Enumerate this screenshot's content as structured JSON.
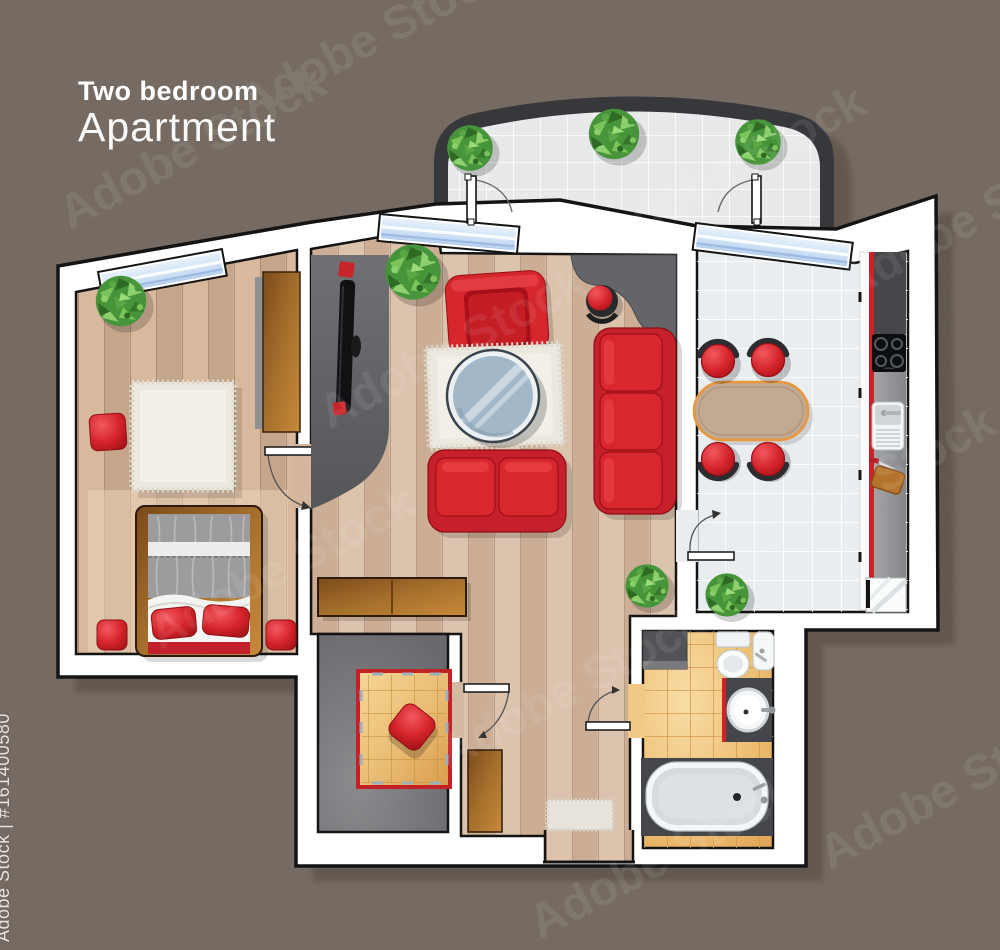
{
  "title": {
    "line1": "Two bedroom",
    "line2": "Apartment"
  },
  "watermark": {
    "brand": "Adobe Stock",
    "credit": "Adobe Stock | #161400580"
  },
  "colors": {
    "background": "#756b62",
    "building_shadow": "#60574e",
    "wall_white": "#ffffff",
    "outline_black": "#141414",
    "balcony_wall": "#37383b",
    "balcony_floor": "#e7e9ea",
    "window_glass": "#c7dcf5",
    "wood_floor": "#d5bba4",
    "bedroom_floor": "#d0b195",
    "kitchen_tile": "#e9edef",
    "bathroom_tile": "#edbd72",
    "gray_floor": "#76767a",
    "accent_red": "#d4232a",
    "counter_red": "#cf2127",
    "furniture_brown": "#a06a28",
    "counter_gray": "#96989a",
    "plant_green": "#5aa746",
    "rug_cream": "#ebe8e0",
    "rug_orange": "#e4b167",
    "table_glass": "#a2b8c8"
  }
}
